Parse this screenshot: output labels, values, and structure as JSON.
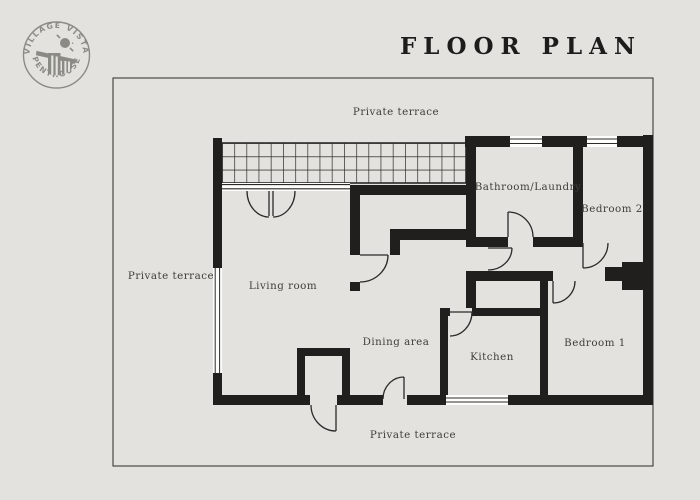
{
  "page": {
    "background_color": "#e4e2de",
    "title": "FLOOR PLAN"
  },
  "logo": {
    "arc_top_text": "· VILLAGE VISTA ·",
    "arc_bottom_text": "PENTHOUSE",
    "color": "#8b8b85"
  },
  "plan": {
    "wall_color": "#211f1e",
    "outline_color": "#2b2a28",
    "window_fill": "#fdfdfc",
    "label_color": "#3f3e3a",
    "rooms": [
      {
        "id": "private-terrace-top",
        "label": "Private terrace"
      },
      {
        "id": "private-terrace-left",
        "label": "Private terrace"
      },
      {
        "id": "private-terrace-bottom",
        "label": "Private terrace"
      },
      {
        "id": "living-room",
        "label": "Living room"
      },
      {
        "id": "dining-area",
        "label": "Dining area"
      },
      {
        "id": "kitchen",
        "label": "Kitchen"
      },
      {
        "id": "bedroom-1",
        "label": "Bedroom 1"
      },
      {
        "id": "bedroom-2",
        "label": "Bedroom 2"
      },
      {
        "id": "bathroom-laundry",
        "label": "Bathroom/Laundry"
      }
    ]
  }
}
